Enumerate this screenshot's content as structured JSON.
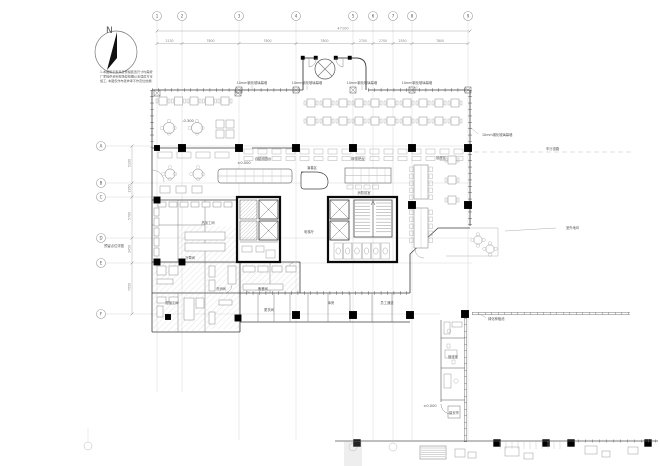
{
  "drawing": {
    "north_label": "N",
    "note_lines": [
      "1.本图所示家具及预留装置尺寸均需按",
      "厂家提供资料现场复核确认无误后方可",
      "施工, 本图仅作布置参考不作定位依据."
    ],
    "grid": {
      "top_bubbles": [
        "1",
        "2",
        "3",
        "4",
        "5",
        "6",
        "7",
        "8",
        "9"
      ],
      "top_dims": [
        "2130",
        "7800",
        "7800",
        "7800",
        "2700",
        "2700",
        "2550",
        "7800"
      ],
      "overall_dim": "47100",
      "left_bubbles": [
        "A",
        "B",
        "C",
        "D",
        "E",
        "F"
      ],
      "left_dims": [
        "5100",
        "1950",
        "5700",
        "3450",
        "7050"
      ]
    },
    "labels": [
      {
        "t": "10mm钢化玻璃幕墙",
        "x": 252,
        "y": 84
      },
      {
        "t": "10mm钢化玻璃幕墙",
        "x": 307,
        "y": 84
      },
      {
        "t": "10mm钢化玻璃幕墙",
        "x": 362,
        "y": 84
      },
      {
        "t": "10mm钢化玻璃幕墙",
        "x": 417,
        "y": 84
      },
      {
        "t": "10mm钢化玻璃幕墙",
        "x": 482,
        "y": 136
      },
      {
        "t": "车行道路",
        "x": 546,
        "y": 150
      },
      {
        "t": "室外地坪",
        "x": 566,
        "y": 229
      },
      {
        "t": "绿化种植池",
        "x": 488,
        "y": 320
      },
      {
        "t": "值班室",
        "x": 453,
        "y": 358
      },
      {
        "t": "保安亭",
        "x": 454,
        "y": 414
      },
      {
        "t": "±0.000",
        "x": 430,
        "y": 407
      },
      {
        "t": "电梯厅",
        "x": 309,
        "y": 233
      },
      {
        "t": "消防前室",
        "x": 364,
        "y": 194
      },
      {
        "t": "服务吧台",
        "x": 358,
        "y": 160
      },
      {
        "t": "自助明档台",
        "x": 263,
        "y": 160
      },
      {
        "t": "±0.000",
        "x": 244,
        "y": 164
      },
      {
        "t": "演奏区",
        "x": 312,
        "y": 169
      },
      {
        "t": "-0.300",
        "x": 188,
        "y": 122
      },
      {
        "t": "热加工间",
        "x": 208,
        "y": 224
      },
      {
        "t": "冷荤间",
        "x": 190,
        "y": 259
      },
      {
        "t": "洗消间",
        "x": 221,
        "y": 290
      },
      {
        "t": "粗加工间",
        "x": 172,
        "y": 304
      },
      {
        "t": "备餐间",
        "x": 263,
        "y": 290
      },
      {
        "t": "更衣间",
        "x": 269,
        "y": 311
      },
      {
        "t": "库房",
        "x": 331,
        "y": 304
      },
      {
        "t": "员工通道",
        "x": 387,
        "y": 304
      },
      {
        "t": "散座区",
        "x": 441,
        "y": 159
      },
      {
        "t": "预留点位详图",
        "x": 114,
        "y": 247
      }
    ]
  }
}
